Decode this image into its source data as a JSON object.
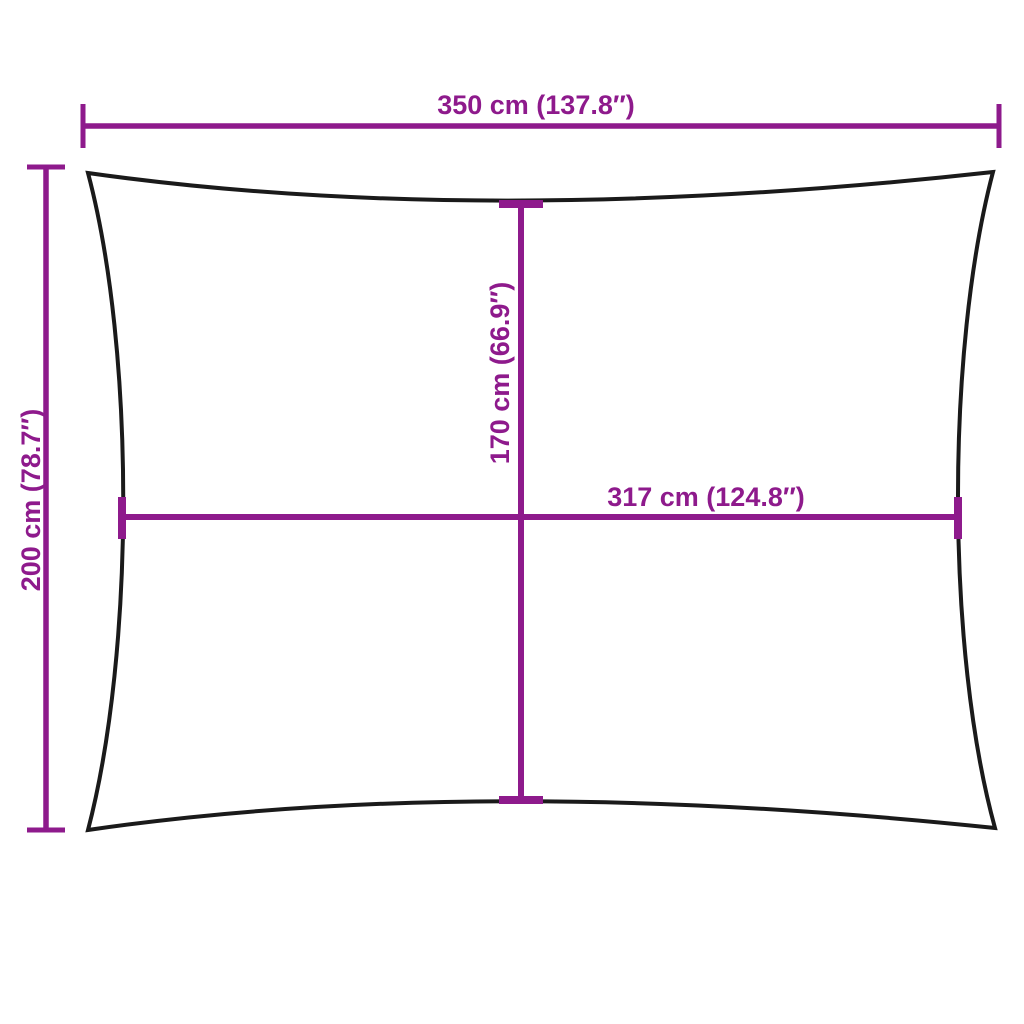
{
  "colors": {
    "accent": "#8e1a8c",
    "outline": "#1a1a1a",
    "background": "#ffffff"
  },
  "dimensions": {
    "overall_width": {
      "cm": 350,
      "inches": 137.8,
      "label": "350 cm (137.8″)"
    },
    "overall_height": {
      "cm": 200,
      "inches": 78.7,
      "label": "200 cm (78.7″)"
    },
    "inner_height": {
      "cm": 170,
      "inches": 66.9,
      "label": "170 cm (66.9″)"
    },
    "inner_width": {
      "cm": 317,
      "inches": 124.8,
      "label": "317 cm (124.8″)"
    }
  }
}
